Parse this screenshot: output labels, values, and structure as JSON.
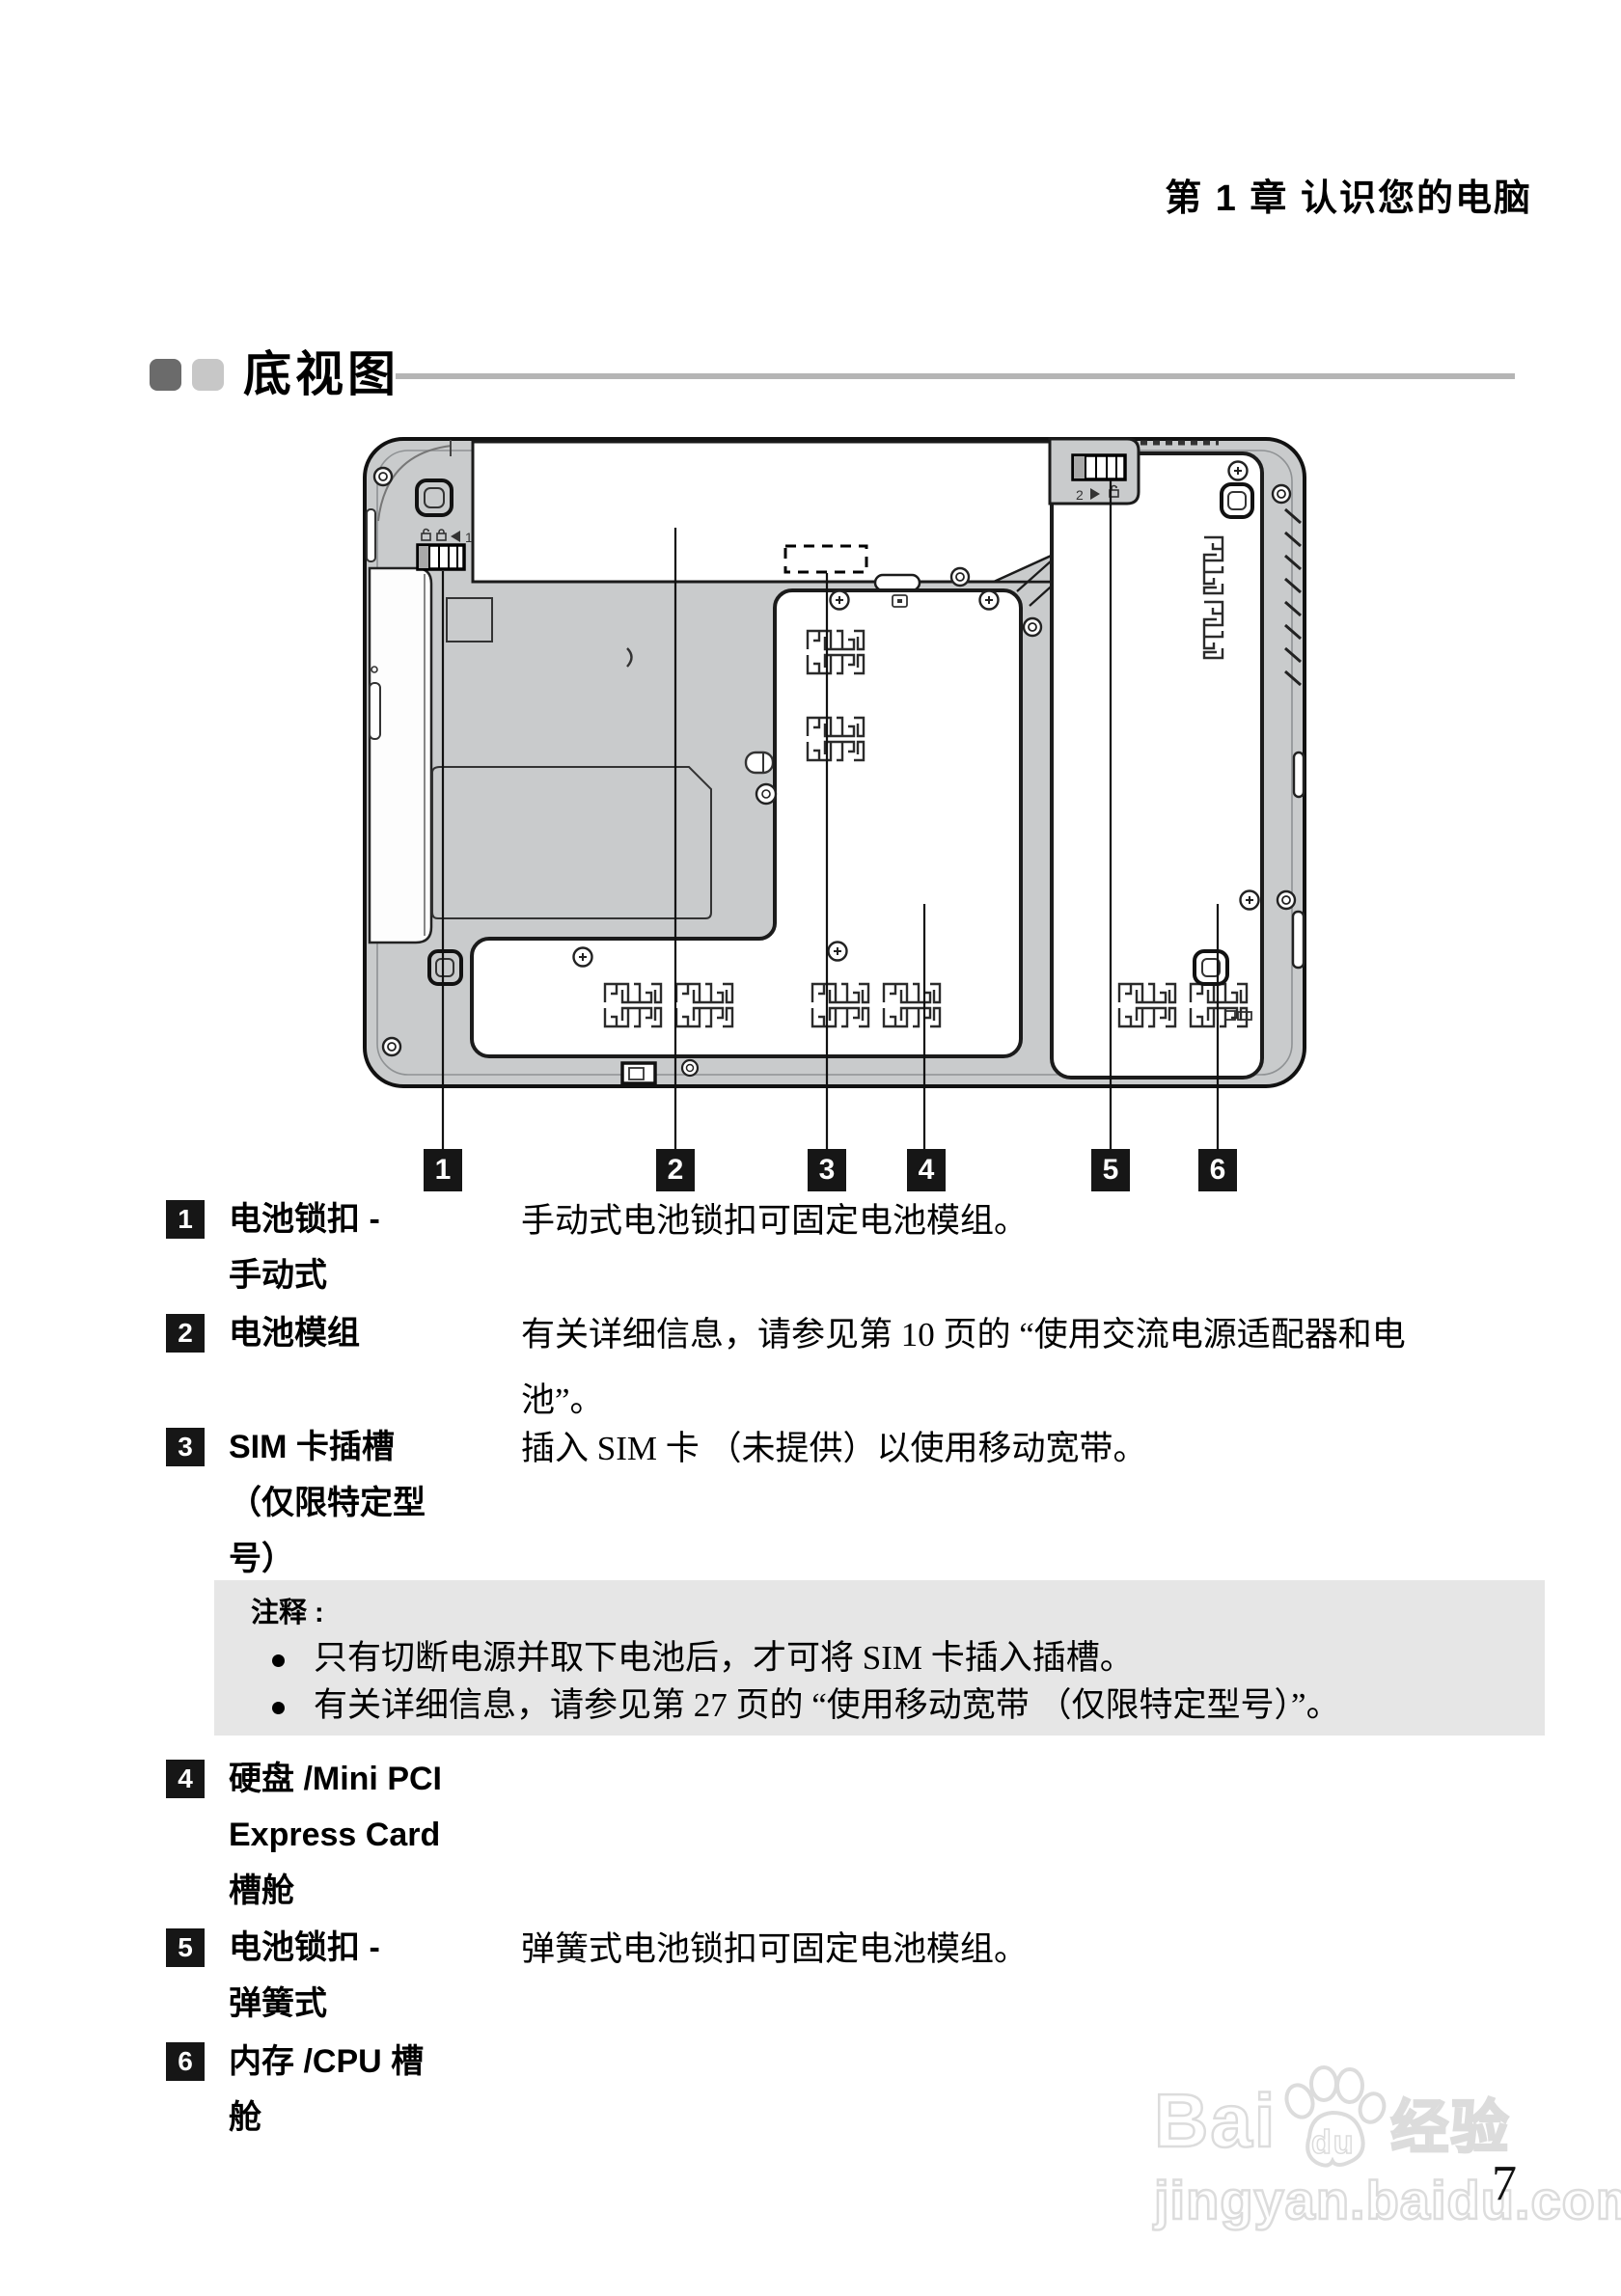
{
  "page": {
    "header": "第 1 章 认识您的电脑",
    "section_title": "底视图",
    "page_number": "7"
  },
  "callouts": [
    "1",
    "2",
    "3",
    "4",
    "5",
    "6"
  ],
  "items": [
    {
      "num": "1",
      "label": "电池锁扣 -\n手动式",
      "desc": "手动式电池锁扣可固定电池模组。"
    },
    {
      "num": "2",
      "label": "电池模组",
      "desc": "有关详细信息，请参见第 10 页的 “使用交流电源适配器和电\n池”。"
    },
    {
      "num": "3",
      "label": "SIM 卡插槽\n（仅限特定型\n号）",
      "desc": "插入 SIM 卡 （未提供）以使用移动宽带。"
    },
    {
      "num": "4",
      "label": "硬盘 /Mini PCI\nExpress Card\n槽舱",
      "desc": ""
    },
    {
      "num": "5",
      "label": "电池锁扣 -\n弹簧式",
      "desc": "弹簧式电池锁扣可固定电池模组。"
    },
    {
      "num": "6",
      "label": "内存 /CPU 槽\n舱",
      "desc": ""
    }
  ],
  "note": {
    "title": "注释 :",
    "bullets": [
      "只有切断电源并取下电池后，才可将 SIM 卡插入插槽。",
      "有关详细信息，请参见第 27 页的 “使用移动宽带 （仅限特定型号）”。"
    ]
  },
  "diagram": {
    "latch1_label": "1",
    "latch2_label": "2"
  },
  "watermark": {
    "brand_left": "Bai",
    "brand_mid": "du",
    "brand_cn": "经验",
    "url": "jingyan.baidu.com"
  },
  "colors": {
    "laptop_gray": "#c9cbcc",
    "note_bg": "#e6e6e6",
    "rule_gray": "#b5b5b5",
    "chip_black": "#161616",
    "watermark_gray": "#dcdcdc"
  }
}
